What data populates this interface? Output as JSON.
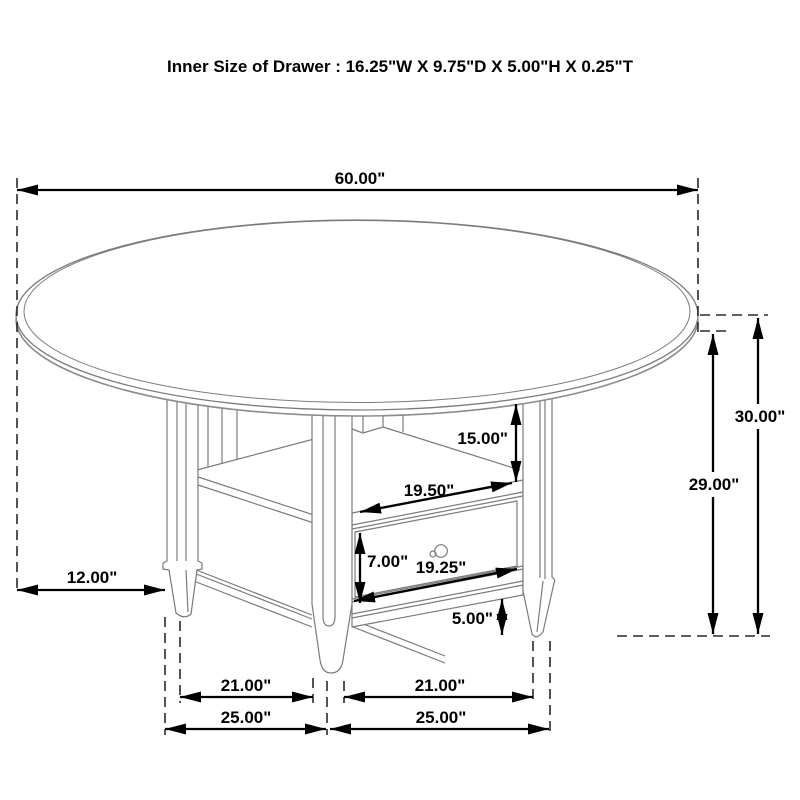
{
  "title": "Inner Size of Drawer : 16.25\"W X 9.75\"D X 5.00\"H X 0.25\"T",
  "dims": {
    "table_diameter": "60.00\"",
    "overall_height": "30.00\"",
    "apron_height": "29.00\"",
    "shelf_opening_height": "15.00\"",
    "shelf_opening_width": "19.50\"",
    "drawer_height": "7.00\"",
    "drawer_width": "19.25\"",
    "leg_floor_clearance": "5.00\"",
    "top_overhang": "12.00\"",
    "inner_leg_span_left": "21.00\"",
    "inner_leg_span_right": "21.00\"",
    "outer_leg_span_left": "25.00\"",
    "outer_leg_span_right": "25.00\""
  },
  "colors": {
    "dimension": "#000000",
    "drawing": "#7b7b7b",
    "background": "#ffffff"
  }
}
